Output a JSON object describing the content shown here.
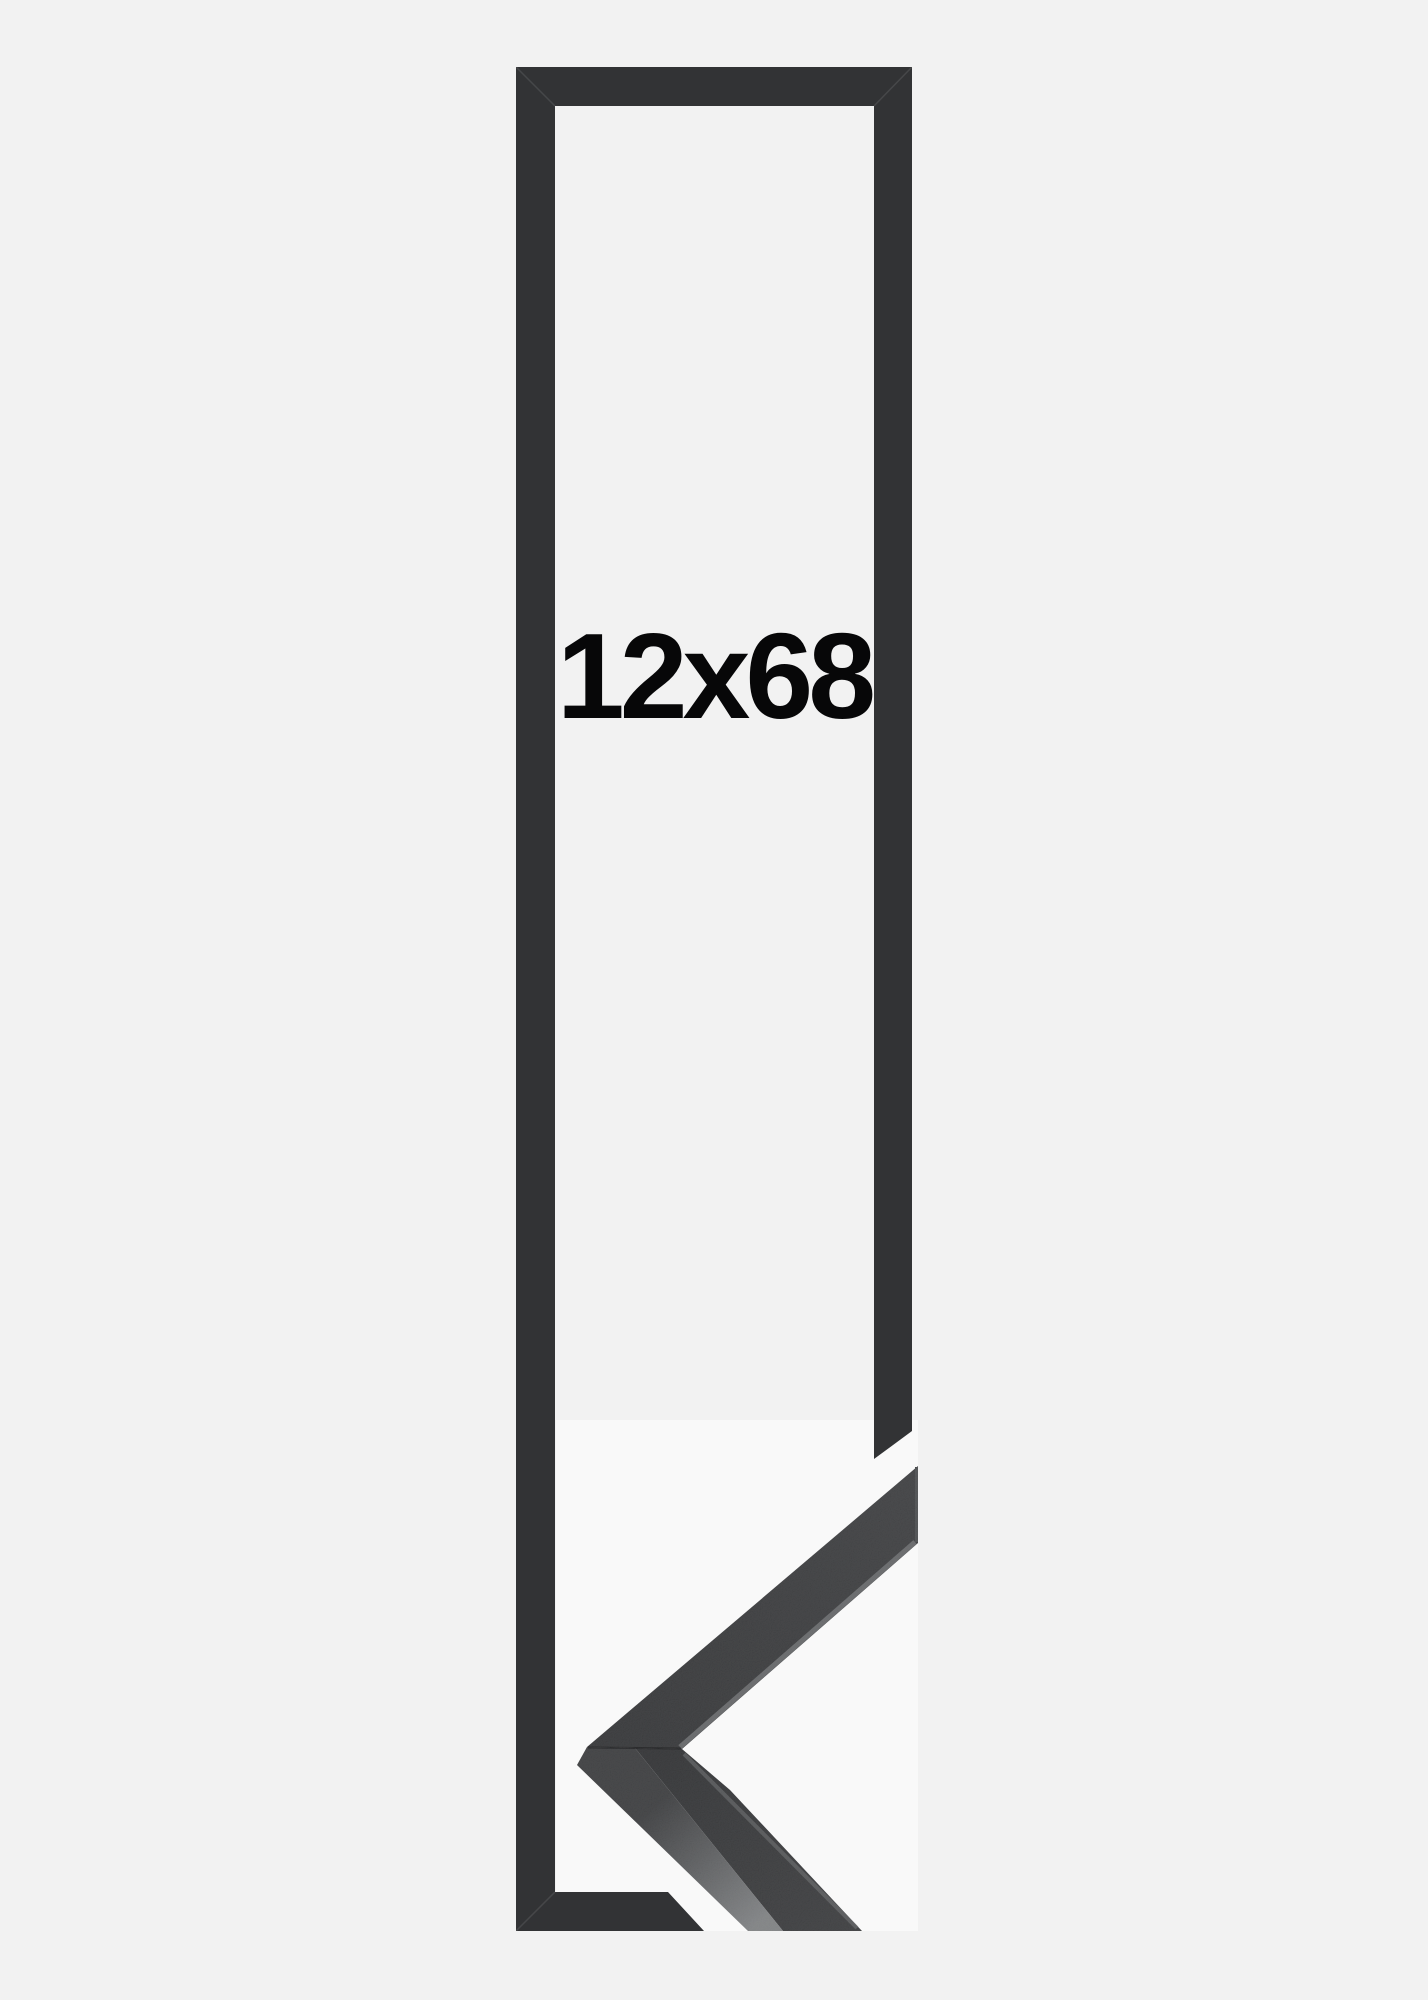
{
  "page": {
    "background": "#f2f2f2"
  },
  "product": {
    "size_label": "12x68",
    "label_color": "#070708"
  },
  "colors": {
    "outline": "#323335",
    "outline_seam": "rgba(255,255,255,0.10)",
    "photo_backdrop": "#ffffff",
    "face_a": "#333436",
    "face_b": "#3d3e40",
    "face_c": "#303133",
    "face_d": "#3a3b3d",
    "side_dark": "#3b3c3e",
    "side_light": "#7d7f81",
    "edge_highlight": "#6b6d6f",
    "end_cut_edge": "#4a4c4e",
    "miter_seam": "rgba(12,12,14,0.55)"
  }
}
